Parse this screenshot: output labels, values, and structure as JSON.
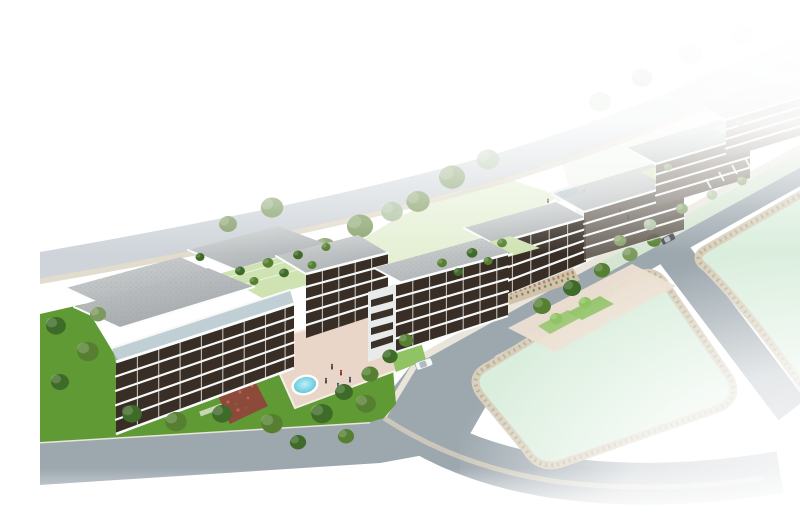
{
  "meta": {
    "description": "Aerial 3D architectural rendering of a modern residential development: three clusters of low-rise apartment buildings with grey roofs, dark wood balconies and rooftop gardens, a paved courtyard with a small oval swimming pool, tree-lined lawns, grey streets with two cars, beige sidewalks and large pale-green empty plots; the scene fades to white at the top and bottom-right edges.",
    "image_type": "architectural-visualization",
    "visible_text": "none"
  },
  "scene": {
    "building_clusters": [
      {
        "name": "left-apartment-complex",
        "floors": 5,
        "features": [
          "rooftop gardens",
          "dark balcony bands",
          "courtyard with oval pool",
          "flower bed"
        ]
      },
      {
        "name": "middle-apartment-building",
        "floors": 5,
        "features": [
          "two offset blocks",
          "roof terraces with trees",
          "stone planting wall",
          "lawn strips"
        ]
      },
      {
        "name": "right-apartment-cluster",
        "floors": 4,
        "features": [
          "three stepped blocks fading into distance",
          "small pool court",
          "street parking stripes"
        ]
      }
    ],
    "landscape": {
      "pools": 2,
      "cars": 2,
      "green_plots": 2,
      "courtyards": 2,
      "people_groups": 3,
      "tree_style": "olive and ornamental canopies"
    }
  },
  "palette": {
    "bg": "#ffffff",
    "road": "#9ca7ae",
    "roadBack": "#c6cdd2",
    "sidewalk": "#e9e5da",
    "curb": "#d8d0bd",
    "curbDot": "#bfb49a",
    "mint": "#daeedd",
    "lawn": "#5f9a34",
    "lawnLight": "#8fc364",
    "lawnPale": "#cfe3b2",
    "backdropGreen": "#e8f1e4",
    "roofLight": "#cdd0d1",
    "roofDark": "#aeb3b5",
    "facadeDark": "#382e26",
    "facadeLight": "#e9ebea",
    "glass": "#a9bfc6",
    "paving": "#ead6c8",
    "pavingRight": "#ecdfd2",
    "wall": "#d2c2ab",
    "flower": "#8d4a3a",
    "flowerDot": "#c2654f",
    "hedge": "#4e7a2f",
    "pool": "#57c7de",
    "poolLight": "#bfeef6",
    "treeDark": "#3f6b28",
    "treeMid": "#567f31",
    "treeOlive": "#7c9a5d",
    "treeFade": "#a7bd99",
    "carWhite": "#f5f7f6",
    "carDark": "#474d52",
    "shadow": "#3c464b"
  }
}
